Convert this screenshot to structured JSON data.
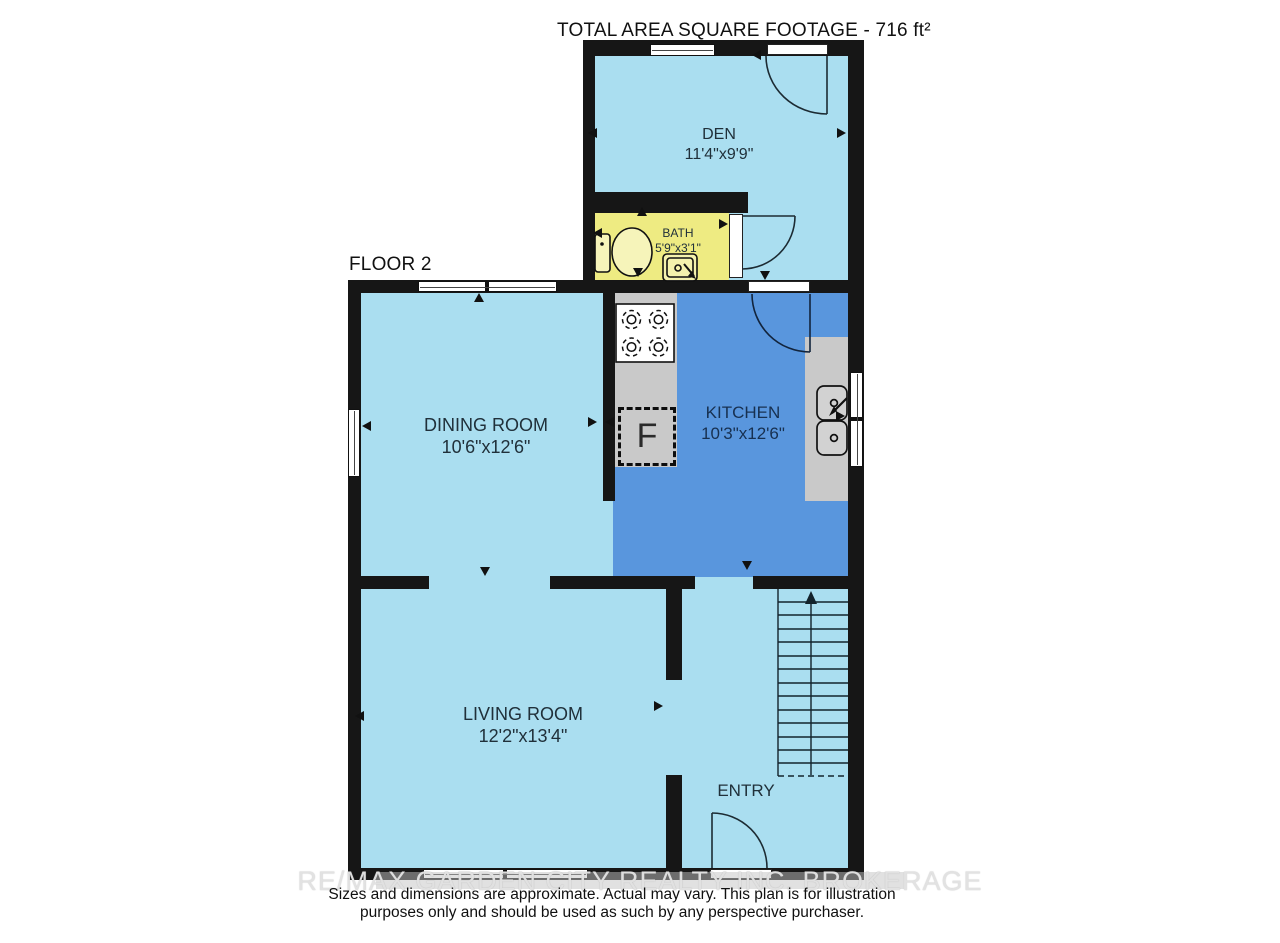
{
  "header": {
    "title": "TOTAL AREA SQUARE FOOTAGE - 716 ft²",
    "floor_label": "FLOOR 2"
  },
  "rooms": {
    "den": {
      "name": "DEN",
      "dims": "11'4\"x9'9\""
    },
    "bath": {
      "name": "BATH",
      "dims": "5'9\"x3'1\""
    },
    "dining": {
      "name": "DINING ROOM",
      "dims": "10'6\"x12'6\""
    },
    "kitchen": {
      "name": "KITCHEN",
      "dims": "10'3\"x12'6\""
    },
    "living": {
      "name": "LIVING ROOM",
      "dims": "12'2\"x13'4\""
    },
    "entry": {
      "name": "ENTRY"
    }
  },
  "fixtures": {
    "fridge_label": "F",
    "items": [
      "stove",
      "refrigerator",
      "double-sink",
      "toilet",
      "bathroom-sink",
      "staircase",
      "door-swings",
      "windows"
    ]
  },
  "footer": {
    "watermark": "RE/MAX GARDEN CITY REALTY INC. BROKERAGE",
    "disclaimer_line1": "Sizes and dimensions are approximate. Actual may vary. This plan is for illustration",
    "disclaimer_line2": "purposes only and should be used as such by any perspective purchaser."
  },
  "colors": {
    "room-light": "#aadef0",
    "kitchen-blue": "#5996dd",
    "bath-yellow": "#eeeb82",
    "counter-gray": "#c9c9c9",
    "wall-black": "#161616",
    "label-text": "#20303a",
    "kitchen-text": "#173050"
  }
}
